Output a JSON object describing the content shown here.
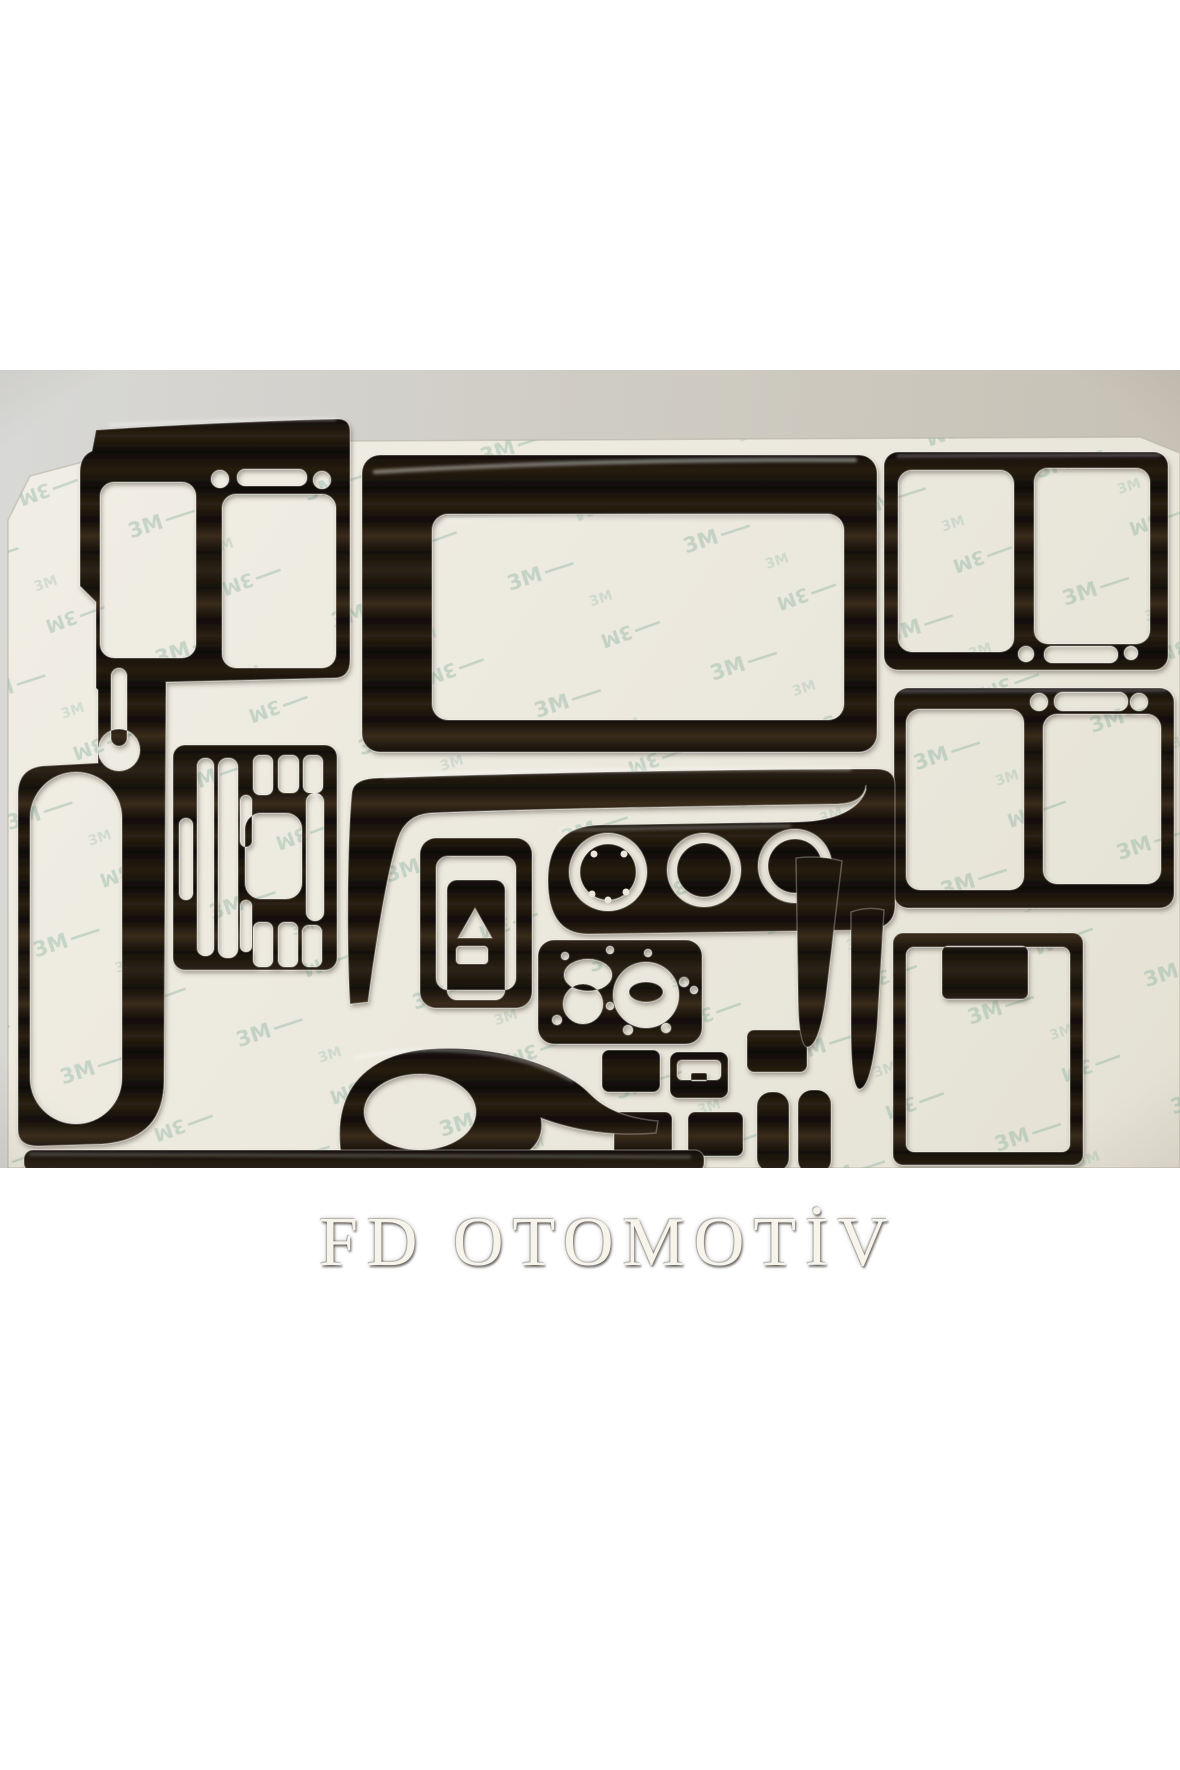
{
  "page": {
    "background_color": "#ffffff"
  },
  "photo": {
    "description": "Dark glossy wood-grain car dashboard trim overlay kit arranged on a cream adhesive backing sheet",
    "table_color": "#d6d6d4",
    "sheet_color": "#efece3",
    "wood_dark_color": "#16100a",
    "wood_light_color": "#3a2c1b"
  },
  "watermark": {
    "text": "FD OTOMOTİV",
    "color": "#f7f4ec"
  },
  "backing_pattern": {
    "text": "3M",
    "color": "#7fae99"
  },
  "pieces": [
    {
      "id": "left_dash_side_panel",
      "label": "left dashboard side panel"
    },
    {
      "id": "switch_cluster_panel",
      "label": "switch cluster panel"
    },
    {
      "id": "radio_surround_frame",
      "label": "radio surround frame"
    },
    {
      "id": "door_panel_upper",
      "label": "upper door trim panel"
    },
    {
      "id": "door_panel_lower",
      "label": "lower door trim panel"
    },
    {
      "id": "center_dash_bezel",
      "label": "center dash gauge bezel"
    },
    {
      "id": "window_switch_surround",
      "label": "window switch surround"
    },
    {
      "id": "light_switch_panel",
      "label": "headlight switch panel"
    },
    {
      "id": "small_switch_blank_a",
      "label": "small switch blank"
    },
    {
      "id": "ashtray_lid",
      "label": "ashtray lid trim"
    },
    {
      "id": "small_switch_blank_b",
      "label": "small switch blank"
    },
    {
      "id": "small_switch_blank_c",
      "label": "small switch blank"
    },
    {
      "id": "small_switch_blank_d",
      "label": "small switch blank"
    },
    {
      "id": "pillar_strip_a",
      "label": "pillar strip"
    },
    {
      "id": "pillar_strip_b",
      "label": "pillar strip"
    },
    {
      "id": "console_side_trim",
      "label": "console side trim"
    },
    {
      "id": "lower_dash_strip",
      "label": "lower dash strip"
    },
    {
      "id": "a_pillar_wedge_a",
      "label": "tapered pillar wedge"
    },
    {
      "id": "a_pillar_wedge_b",
      "label": "tapered pillar wedge"
    },
    {
      "id": "rear_quarter_panel",
      "label": "rear quarter trim panel"
    }
  ]
}
